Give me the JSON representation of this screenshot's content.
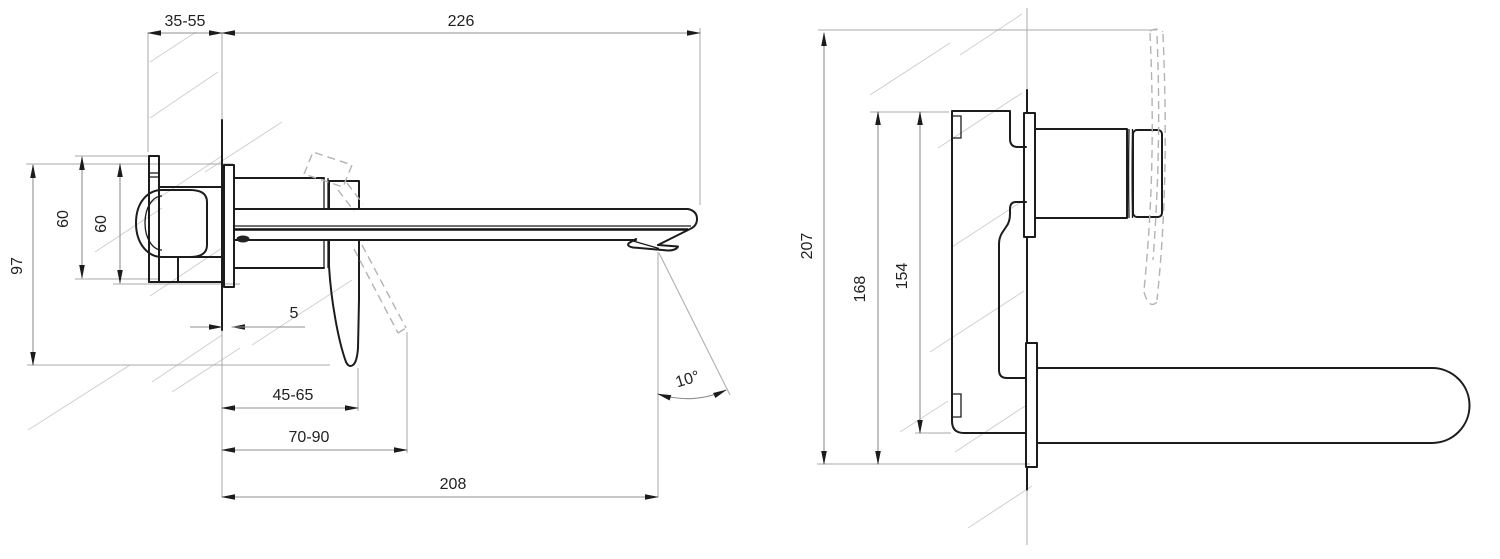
{
  "drawing": {
    "title": "Wall-mounted basin mixer installation dimensions",
    "dims": {
      "side": {
        "wall_depth": "35-55",
        "spout_length": "226",
        "bracket_height": "60",
        "plate_height": "60",
        "total_height": "97",
        "plate_gap": "5",
        "handle_min": "45-65",
        "handle_max": "70-90",
        "spout_reach": "208",
        "spout_angle": "10°"
      },
      "front": {
        "overall_height": "207",
        "body_height": "168",
        "housing_height": "154"
      }
    }
  }
}
